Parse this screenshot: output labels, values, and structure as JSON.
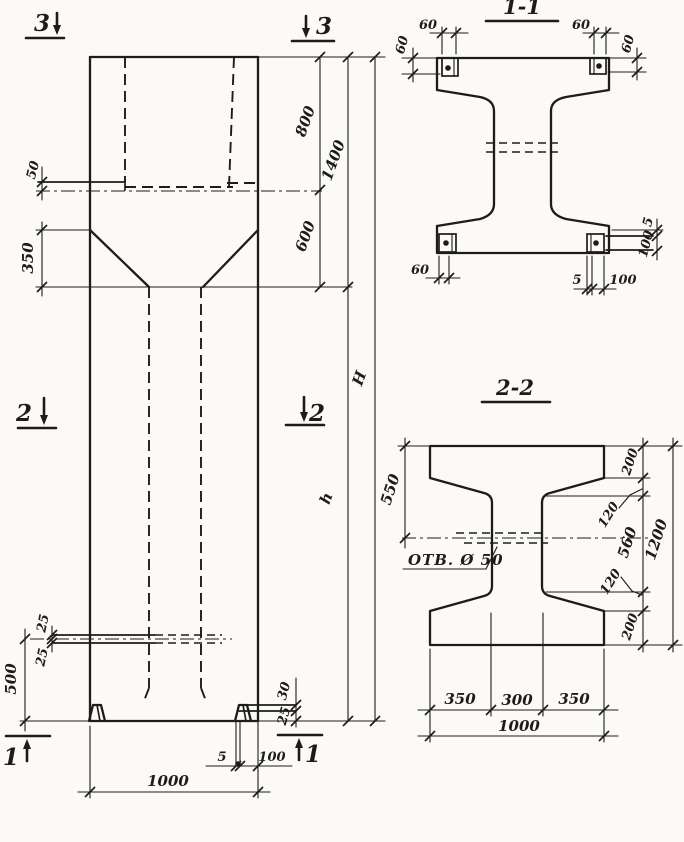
{
  "drawing_type": "reinforced-concrete column working drawing",
  "elevation": {
    "mark_3": "3",
    "mark_2": "2",
    "mark_1": "1",
    "dim_slot_depth": "50",
    "dim_taper": "350",
    "dim_800": "800",
    "dim_600": "600",
    "dim_1400": "1400",
    "dim_h": "h",
    "dim_H": "H",
    "dim_25_upper": "25",
    "dim_25_lower": "25",
    "dim_500": "500",
    "dim_foot_30": "30",
    "dim_foot_25": "25",
    "dim_plate_5": "5",
    "dim_plate_100": "100",
    "dim_width_1000": "1000"
  },
  "section_1_1": {
    "title": "1-1",
    "dim_tl_60w": "60",
    "dim_tl_60h": "60",
    "dim_tr_60w": "60",
    "dim_tr_60h": "60",
    "dim_bl_60": "60",
    "dim_b_5": "5",
    "dim_b_100": "100",
    "dim_r_5": "5",
    "dim_r_100": "100"
  },
  "section_2_2": {
    "title": "2-2",
    "hole_label": "ОТВ. Ø 50",
    "dim_550": "550",
    "dim_200_top": "200",
    "dim_120_top": "120",
    "dim_560": "560",
    "dim_120_bottom": "120",
    "dim_200_bottom": "200",
    "dim_1200": "1200",
    "dim_350_left": "350",
    "dim_300": "300",
    "dim_350_right": "350",
    "dim_1000": "1000"
  }
}
